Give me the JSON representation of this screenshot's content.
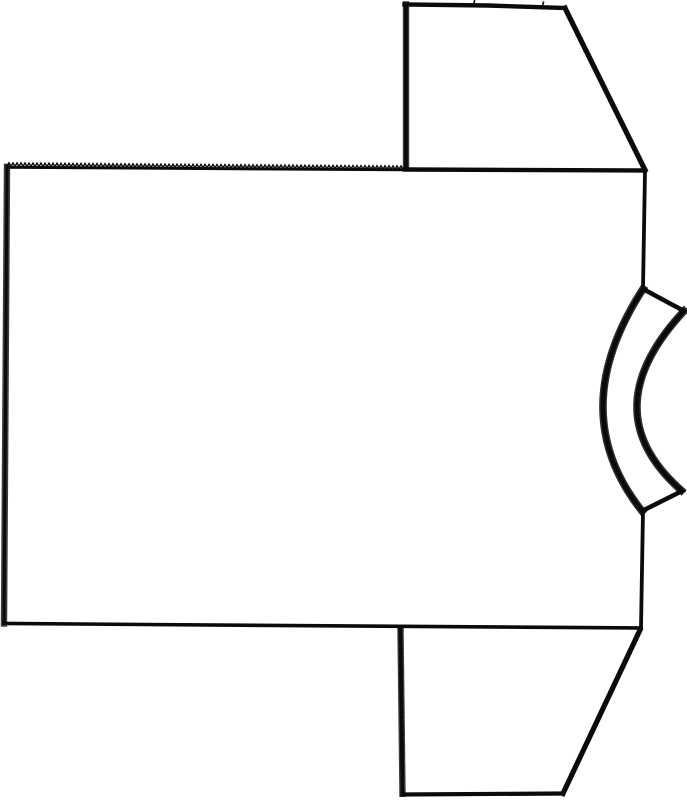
{
  "canvas": {
    "width": 687,
    "height": 800,
    "background": "#ffffff",
    "ink": "#0b0b0b"
  },
  "figure": {
    "alt": "Black outline sewing-pattern style line drawing of a T-shirt lying on its side: rectangular body panel with serrated top edge, two trapezoid sleeves extending from the upper-right and lower-right, and a curved crescent neckband on the middle of the right edge",
    "pieces": {
      "body": {
        "top_serration": {
          "start_x": 7,
          "start_y": 166.2,
          "end_x": 405,
          "period": 4,
          "amplitude": 3.4,
          "tilt_deg": 0.45
        },
        "top_edge_base": "M7,167.3 L405,169.8",
        "shoulder_seam": "M405,169.5 L645,170.5",
        "right_edge_upper": "M645,171 L643,288",
        "right_edge_lower": "M643,511 L641,628",
        "bottom_edge": "M641,628 L4,623.5",
        "left_edge": "M4,623.5 L7,166.5"
      },
      "sleeve_top": {
        "left_edge": "M406,168 L406,4.5",
        "top_edge": "M404.5,4.5 L488,5.5 L565,8",
        "underarm_diagonal": "M565,8 L645,170",
        "notch_1": "M473.5,4.5 L474.5,0.8",
        "notch_2": "M542.5,6 L543.5,2.2"
      },
      "sleeve_bottom": {
        "left_edge": "M400.5,629.5 L402.5,794.5",
        "bottom_edge": "M402.5,794.5 L563,793.5",
        "underarm_diagonal": "M563,793.5 L640,630"
      },
      "neckband": {
        "outline": "M643,289 L684,311 Q591,411 682,491 L642,511 Q563.5,412 643,289 Z",
        "outer_arc": "M684,311 Q591,411 682,491",
        "inner_arc": "M643,289 Q563.5,412 642,511"
      }
    }
  }
}
